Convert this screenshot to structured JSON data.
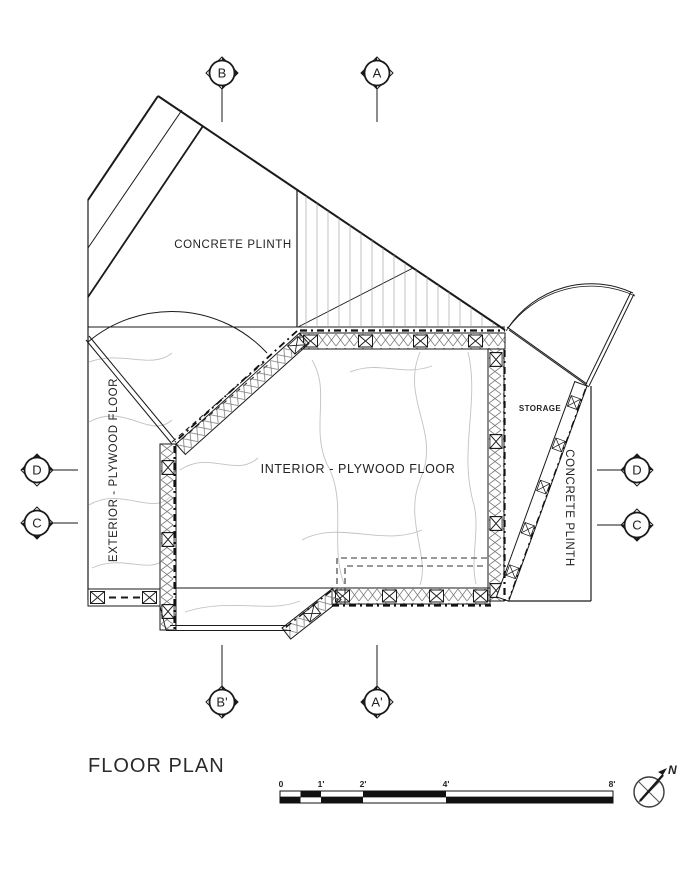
{
  "title": "FLOOR PLAN",
  "labels": {
    "concrete_plinth_top": "CONCRETE PLINTH",
    "exterior_floor": "EXTERIOR - PLYWOOD FLOOR",
    "interior_floor": "INTERIOR - PLYWOOD FLOOR",
    "storage": "STORAGE",
    "concrete_plinth_right": "CONCRETE PLINTH"
  },
  "section_markers": {
    "top_b": "B",
    "top_a": "A",
    "left_d": "D",
    "left_c": "C",
    "right_d": "D",
    "right_c": "C",
    "bottom_b": "B'",
    "bottom_a": "A'"
  },
  "scale_bar": {
    "ticks": [
      "0",
      "1'",
      "2'",
      "4'",
      "8'"
    ]
  },
  "north_indicator": {
    "label": "N"
  },
  "colors": {
    "line": "#1a1a1a",
    "light_line": "#8a8a8a",
    "contour": "#c2c2c2"
  }
}
